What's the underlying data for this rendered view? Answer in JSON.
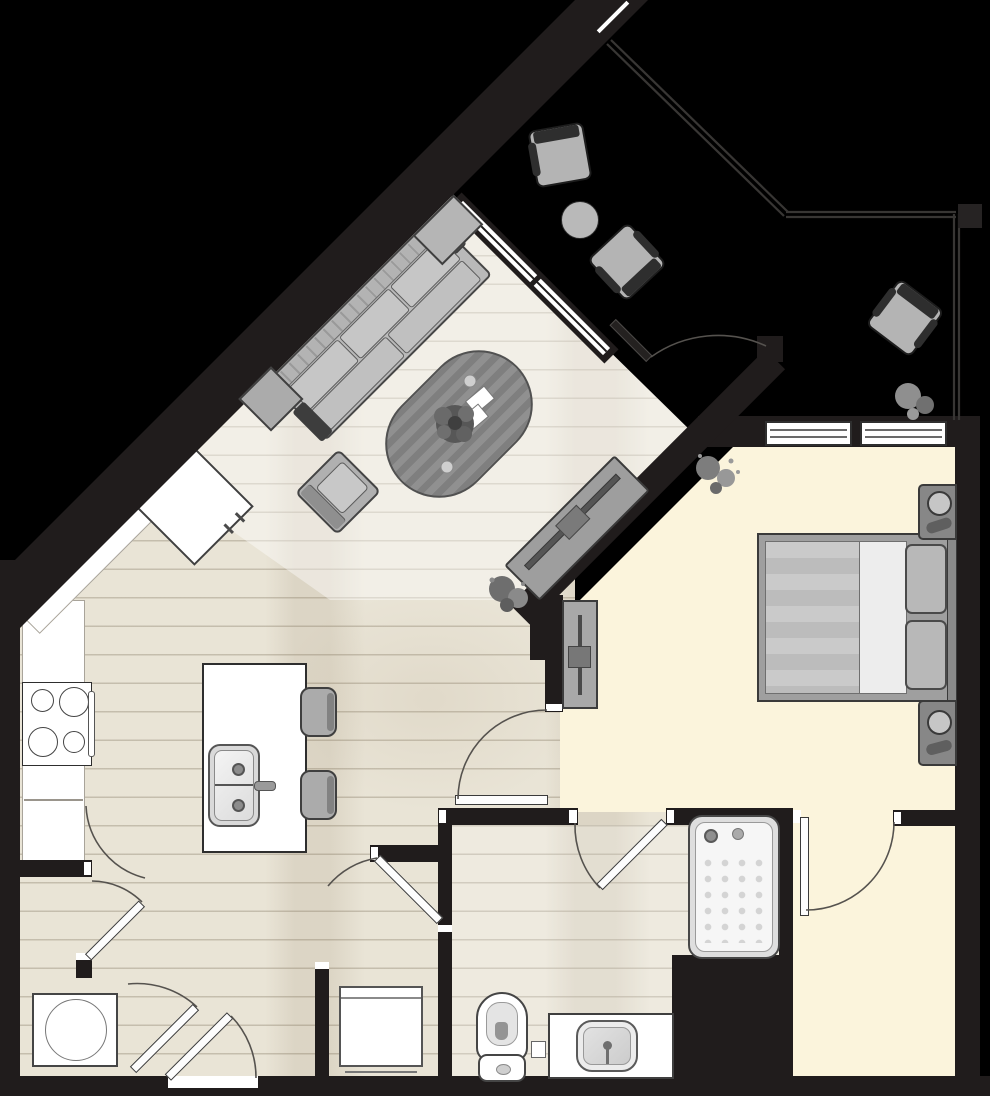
{
  "meta": {
    "kind": "apartment-floor-plan",
    "visible_text": [],
    "orientation": "diagonal-living-wing"
  },
  "palette": {
    "bg": "#000000",
    "wall": "#201c1c",
    "wood": "#e9e4d6",
    "wood-line": "rgba(120,108,86,.32)",
    "cream": "#fbf4dc",
    "white": "#ffffff",
    "furn": "#b5b5b5",
    "furn-dark": "#3f3f3f",
    "furn-mid": "#8f8f8f",
    "arc": "#55524e",
    "rail": "#383634"
  },
  "rooms": {
    "living_room": {
      "floor": "light wood planks",
      "furniture": [
        "sectional-sofa",
        "side-table",
        "ottoman",
        "oval-striped-rug",
        "potted-plant-on-rug",
        "magazines",
        "armchair",
        "tv-console",
        "floor-plant"
      ]
    },
    "kitchen": {
      "floor": "wood planks",
      "fixtures": [
        "l-shaped-counter",
        "refrigerator",
        "cooktop-4-burners",
        "island",
        "double-sink",
        "faucet",
        "bar-stool",
        "bar-stool"
      ]
    },
    "bedroom": {
      "floor": "cream carpet",
      "furniture": [
        "queen-bed-striped-duvet",
        "pillow",
        "pillow",
        "nightstand-with-lamp",
        "nightstand-with-lamp",
        "dresser-tv-stand",
        "plant"
      ],
      "windows": 2
    },
    "bathroom": {
      "fixtures": [
        "bathtub",
        "toilet",
        "vanity-sink"
      ]
    },
    "walk_in_closet": {
      "floor": "cream carpet"
    },
    "laundry": {
      "fixtures": [
        "washer"
      ]
    },
    "hall_closet": {
      "fixtures": [
        "storage-cabinet"
      ]
    },
    "patio": {
      "floor": "black",
      "furniture": [
        "outdoor-chair",
        "outdoor-chair",
        "outdoor-chair",
        "round-table",
        "plant"
      ],
      "boundary": "railing"
    },
    "doors": [
      "entry-door",
      "bedroom-door",
      "bathroom-door",
      "closet-door",
      "patio-door",
      "laundry-door",
      "pantry-door",
      "hall-closet-door",
      "corridor-door"
    ]
  }
}
